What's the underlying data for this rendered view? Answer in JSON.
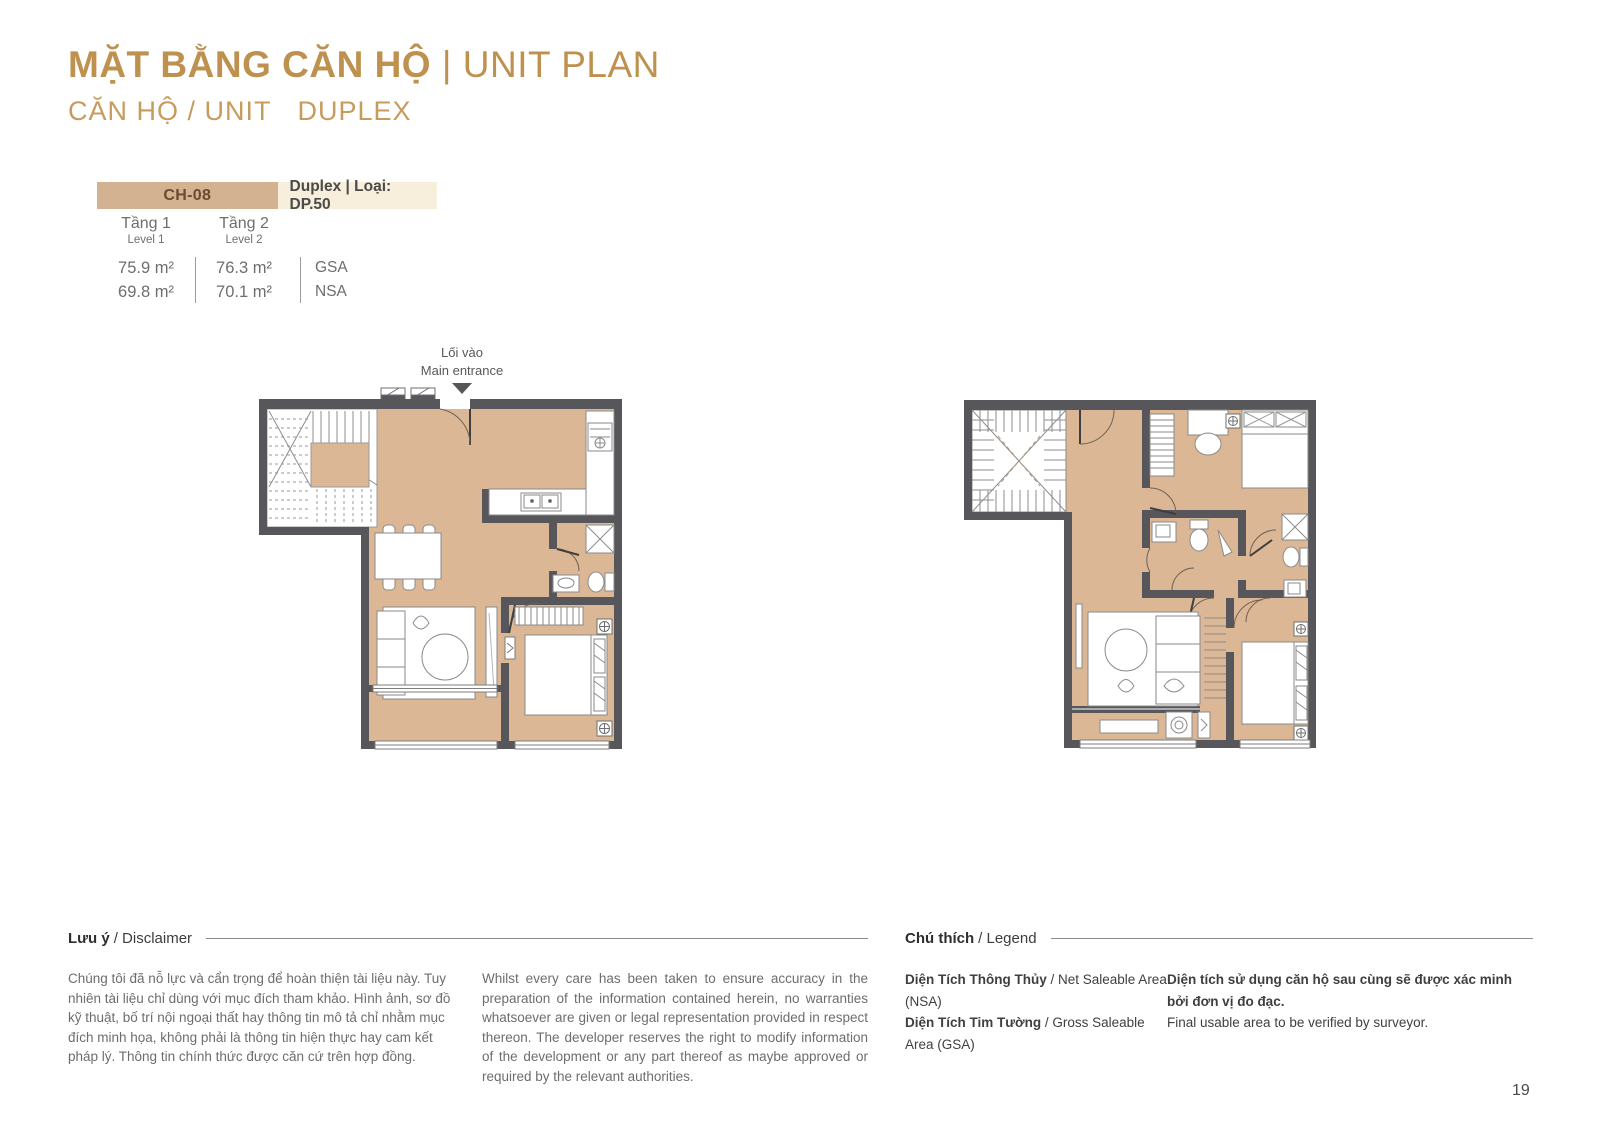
{
  "header": {
    "title_main": "MẶT BẰNG CĂN HỘ",
    "title_divider": "|",
    "title_sub": "UNIT PLAN",
    "subtitle_left": "CĂN HỘ / UNIT",
    "subtitle_type": "DUPLEX"
  },
  "unit_table": {
    "unit_code": "CH-08",
    "unit_type": "Duplex | Loại: DP.50",
    "columns": [
      {
        "level_vi": "Tầng 1",
        "level_en": "Level 1",
        "gsa": "75.9 m²",
        "nsa": "69.8 m²"
      },
      {
        "level_vi": "Tầng 2",
        "level_en": "Level 2",
        "gsa": "76.3 m²",
        "nsa": "70.1 m²"
      }
    ],
    "gsa_label": "GSA",
    "nsa_label": "NSA"
  },
  "entrance": {
    "label_vi": "Lối vào",
    "label_en": "Main entrance"
  },
  "disclaimer": {
    "heading_bold": "Lưu ý",
    "heading_rest": "/ Disclaimer",
    "text_vi": "Chúng tôi đã nỗ lực và cẩn trọng để hoàn thiện tài liệu này. Tuy nhiên tài liệu chỉ dùng với mục đích tham khảo. Hình ảnh, sơ đồ kỹ thuật, bố trí nội ngoại thất hay thông tin mô tả chỉ nhằm mục đích minh họa, không phải là thông tin hiện thực hay cam kết pháp lý. Thông tin chính thức được căn cứ trên hợp đồng.",
    "text_en": "Whilst every care has been taken to ensure accuracy in the preparation of the information contained herein, no warranties whatsoever are given or legal representation provided in respect thereon. The developer reserves the right to modify information of the development or any part thereof as maybe approved or required by the relevant authorities."
  },
  "legend": {
    "heading_bold": "Chú thích",
    "heading_rest": "/ Legend",
    "items": [
      {
        "bold": "Diện Tích Thông Thủy",
        "rest": " / Net Saleable Area (NSA)"
      },
      {
        "bold": "Diện Tích Tim Tường",
        "rest": " / Gross Saleable Area (GSA)"
      }
    ],
    "note_bold": "Diện tích sử dụng căn hộ sau cùng sẽ được xác minh bởi đơn vị đo đạc.",
    "note_rest": "Final usable area to be verified by surveyor."
  },
  "page_number": "19",
  "colors": {
    "accent": "#BE914E",
    "bar_bg": "#D3B291",
    "bar_bg_light": "#F7EFDC",
    "floor": "#DBB795",
    "wall": "#57565A"
  }
}
